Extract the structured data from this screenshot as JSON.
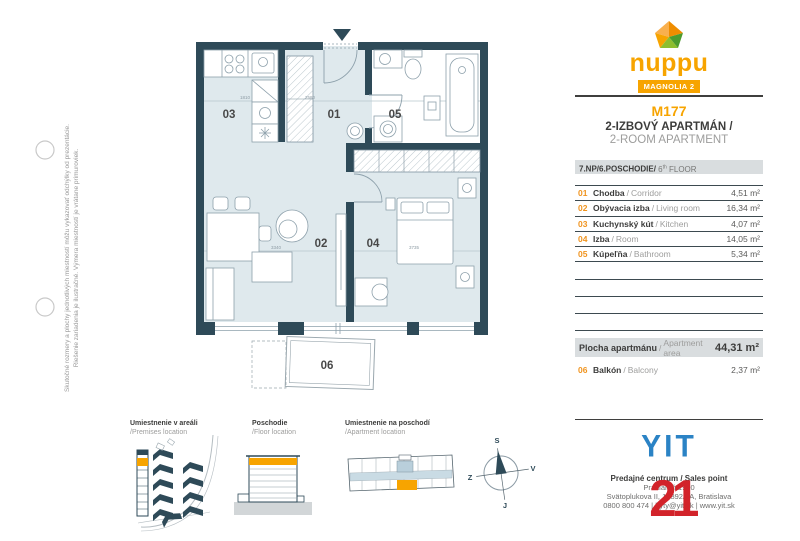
{
  "disclaimer": {
    "line1": "Skutočné rozmery a plochy jednotlivých miestností môžu vykazovať odchýlky od prezentácie.",
    "line2": "Riešenie zariadenia je ilustračné. Výmera miestností je vrátane primuroviek."
  },
  "plan": {
    "room_labels": [
      {
        "num": "01"
      },
      {
        "num": "02"
      },
      {
        "num": "03"
      },
      {
        "num": "04"
      },
      {
        "num": "05"
      },
      {
        "num": "06"
      }
    ],
    "dimensions": [
      {
        "text": "1810"
      },
      {
        "text": "2580"
      },
      {
        "text": "3340"
      },
      {
        "text": "3735"
      }
    ]
  },
  "panel": {
    "brand": {
      "wordmark": "nuppu",
      "project": "MAGNOLIA 2"
    },
    "unit_code": "M177",
    "unit_type_sk": "2-IZBOVÝ APARTMÁN /",
    "unit_type_en": "2-ROOM APARTMENT",
    "floor": {
      "sk": "7.NP/6.POSCHODIE/",
      "en_num": " 6",
      "en_sup": "th",
      "en_rest": " FLOOR"
    },
    "sep": "/",
    "rooms": [
      {
        "num": "01",
        "sk": "Chodba",
        "en": "Corridor",
        "area": "4,51 m²"
      },
      {
        "num": "02",
        "sk": "Obývacia izba",
        "en": "Living room",
        "area": "16,34 m²"
      },
      {
        "num": "03",
        "sk": "Kuchynský kút",
        "en": "Kitchen",
        "area": "4,07 m²"
      },
      {
        "num": "04",
        "sk": "Izba",
        "en": "Room",
        "area": "14,05 m²"
      },
      {
        "num": "05",
        "sk": "Kúpeľňa",
        "en": "Bathroom",
        "area": "5,34 m²"
      }
    ],
    "summary": {
      "sk": "Plocha apartmánu",
      "en": "Apartment area",
      "value": "44,31 m²"
    },
    "balcony": {
      "num": "06",
      "sk": "Balkón",
      "en": "Balcony",
      "area": "2,37 m²"
    },
    "yit_logo": "YIT",
    "contact": {
      "line1": "Predajné centrum / Sales point",
      "line2": "Pradiareň 1900",
      "line3": "Svätoplukova II, 18892/2A, Bratislava",
      "line4": "0800 800 474 | byty@yit.sk | www.yit.sk"
    },
    "watermark": "21"
  },
  "legend": {
    "premises": {
      "sk": "Umiestnenie v areáli",
      "en": "/Premises location"
    },
    "floor": {
      "sk": "Poschodie",
      "en": "/Floor location"
    },
    "apartment": {
      "sk": "Umiestnenie na poschodí",
      "en": "/Apartment location"
    },
    "compass": {
      "n": "S",
      "e": "V",
      "s": "J",
      "w": "Z"
    }
  },
  "colors": {
    "accent_orange": "#f7a400",
    "wall_dark": "#2e4a58",
    "floor_fill": "#dfe9ed",
    "yit_blue": "#2b83c5",
    "watermark_red": "#d2232a",
    "band_grey": "#d9dddf"
  }
}
